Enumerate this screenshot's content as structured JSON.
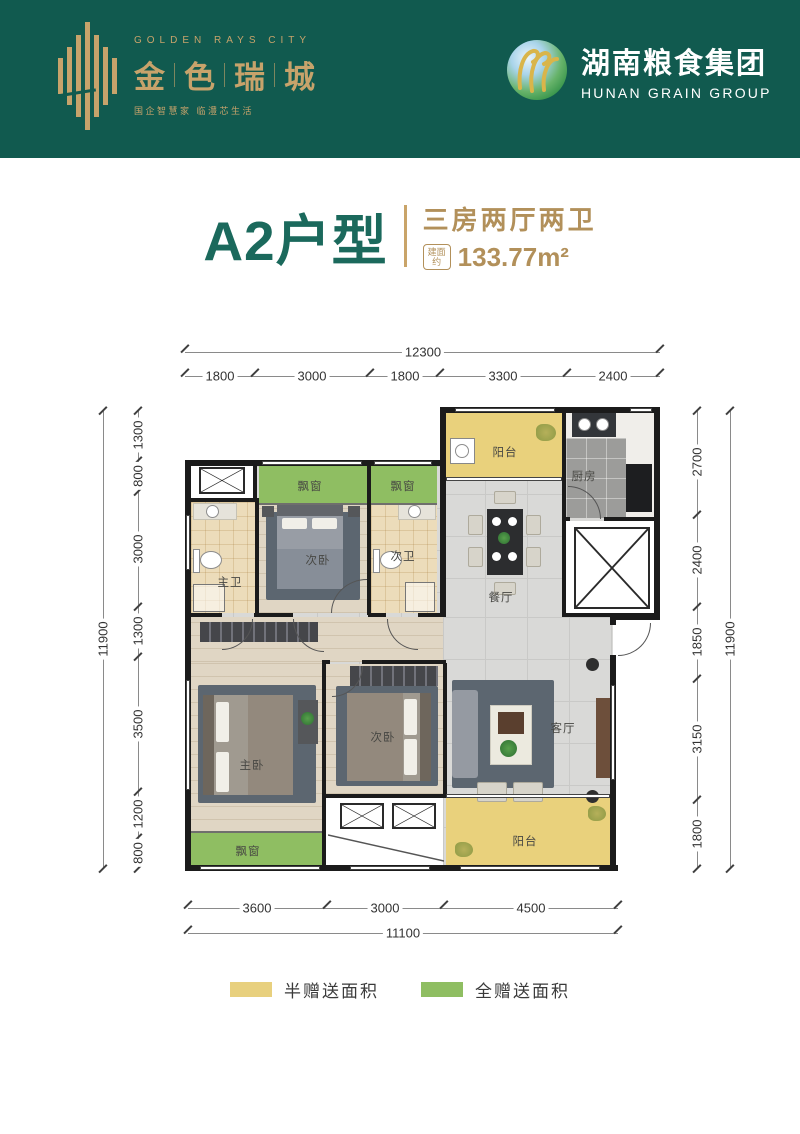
{
  "header": {
    "band_color": "#115a4f",
    "gold": "#c7a36b",
    "left": {
      "brand_en": "GOLDEN RAYS CITY",
      "chars": [
        "金",
        "色",
        "瑞",
        "城"
      ],
      "tagline": "国企智慧家  临澧芯生活"
    },
    "right": {
      "name_cn": "湖南粮食集团",
      "name_en": "HUNAN GRAIN GROUP"
    }
  },
  "title": {
    "unit_name": "A2户型",
    "layout_desc": "三房两厅两卫",
    "area_badge": [
      "建面",
      "约"
    ],
    "area_value": "133.77",
    "area_unit": "m²"
  },
  "dims": {
    "top": {
      "total": "12300",
      "segments": [
        "1800",
        "3000",
        "1800",
        "3300",
        "2400"
      ]
    },
    "bottom": {
      "total": "11100",
      "segments": [
        "3600",
        "3000",
        "4500"
      ]
    },
    "left": {
      "total": "11900",
      "segments": [
        "1300",
        "800",
        "3000",
        "1300",
        "3500",
        "1200",
        "800"
      ]
    },
    "right": {
      "total": "11900",
      "segments": [
        "2700",
        "2400",
        "1850",
        "3150",
        "1800"
      ]
    }
  },
  "plan": {
    "labels": {
      "balcony_top": "阳台",
      "kitchen": "厨房",
      "dining": "餐厅",
      "bath_master": "主卫",
      "bedroom2": "次卧",
      "bath2": "次卫",
      "bay1": "飘窗",
      "bay2": "飘窗",
      "master": "主卧",
      "bedroom3": "次卧",
      "living": "客厅",
      "balcony_bottom": "阳台",
      "bay_master": "飘窗"
    },
    "area_colors": {
      "half_gift": "#e8d07e",
      "full_gift": "#8fbe62"
    }
  },
  "legend": {
    "items": [
      {
        "label": "半赠送面积",
        "color": "#e8d07e"
      },
      {
        "label": "全赠送面积",
        "color": "#8fbe62"
      }
    ]
  }
}
